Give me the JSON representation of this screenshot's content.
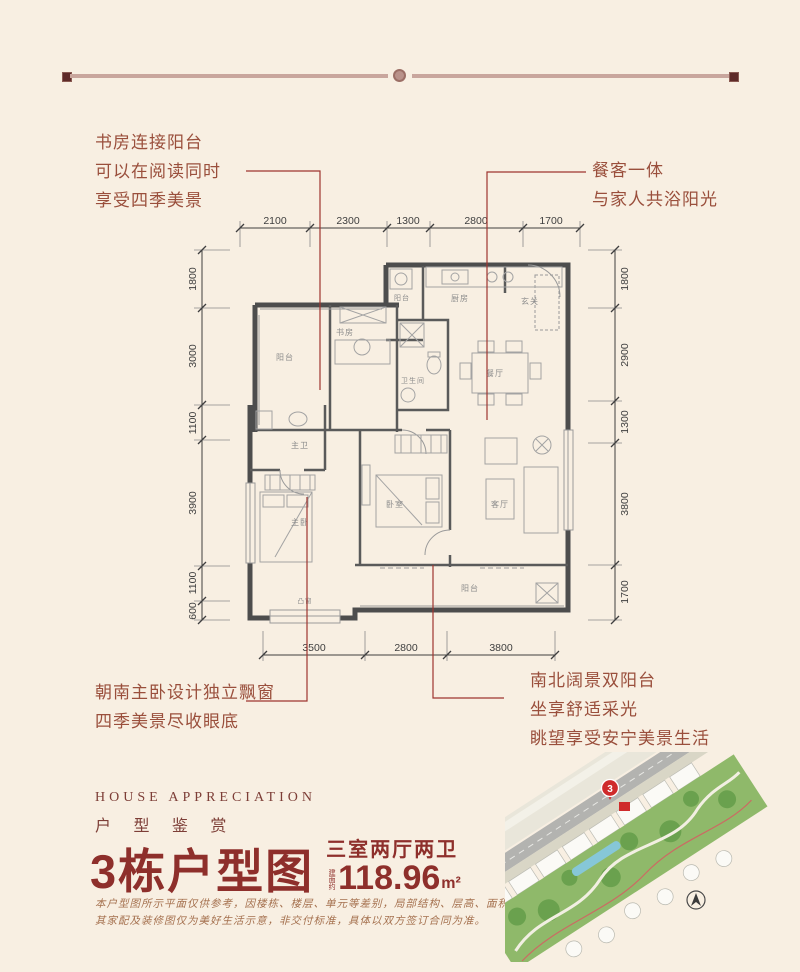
{
  "annotations": {
    "top_left": {
      "lines": [
        "书房连接阳台",
        "可以在阅读同时",
        "享受四季美景"
      ]
    },
    "top_right": {
      "lines": [
        "餐客一体",
        "与家人共浴阳光"
      ]
    },
    "bottom_left": {
      "lines": [
        "朝南主卧设计独立飘窗",
        "四季美景尽收眼底"
      ]
    },
    "bottom_right": {
      "lines": [
        "南北阔景双阳台",
        "坐享舒适采光",
        "眺望享受安宁美景生活"
      ]
    }
  },
  "plan": {
    "dims": {
      "top": [
        "2100",
        "2300",
        "1300",
        "2800",
        "1700"
      ],
      "left": [
        "1800",
        "3000",
        "1100",
        "3900",
        "1100",
        "600"
      ],
      "right": [
        "1800",
        "2900",
        "1300",
        "3800",
        "1700"
      ],
      "bottom": [
        "3500",
        "2800",
        "3800"
      ]
    },
    "rooms": {
      "balcony_top": "阳台",
      "study": "书房",
      "bath": "卫生间",
      "service_balcony": "阳台",
      "kitchen": "厨房",
      "foyer": "玄关",
      "dining": "餐厅",
      "master_bath": "主卫",
      "master_bedroom": "主卧",
      "bedroom": "卧室",
      "living": "客厅",
      "balcony_bottom": "阳台",
      "bay_window": "凸窗"
    }
  },
  "brand": {
    "eyebrow_en": "HOUSE APPRECIATION",
    "eyebrow_cn": "户 型 鉴 赏",
    "title": "3栋户型图",
    "subtitle": "三室两厅两卫",
    "area_prefix": "建面约",
    "area_value": "118.96",
    "area_unit": "m²",
    "disclaimer_line1": "本户型图所示平面仅供参考，因楼栋、楼层、单元等差别，局部结构、层高、面积等可能不同；",
    "disclaimer_line2": "其家配及装修图仅为美好生活示意，非交付标准，具体以双方签订合同为准。"
  },
  "siteplan": {
    "marker": "3"
  },
  "colors": {
    "background": "#f8efe2",
    "accent_maroon": "#8e2f2b",
    "annotation_text": "#9a4f3c",
    "leader_red": "#9e352f",
    "wall": "#4d4d4d",
    "marker_red": "#cf2b2b"
  }
}
